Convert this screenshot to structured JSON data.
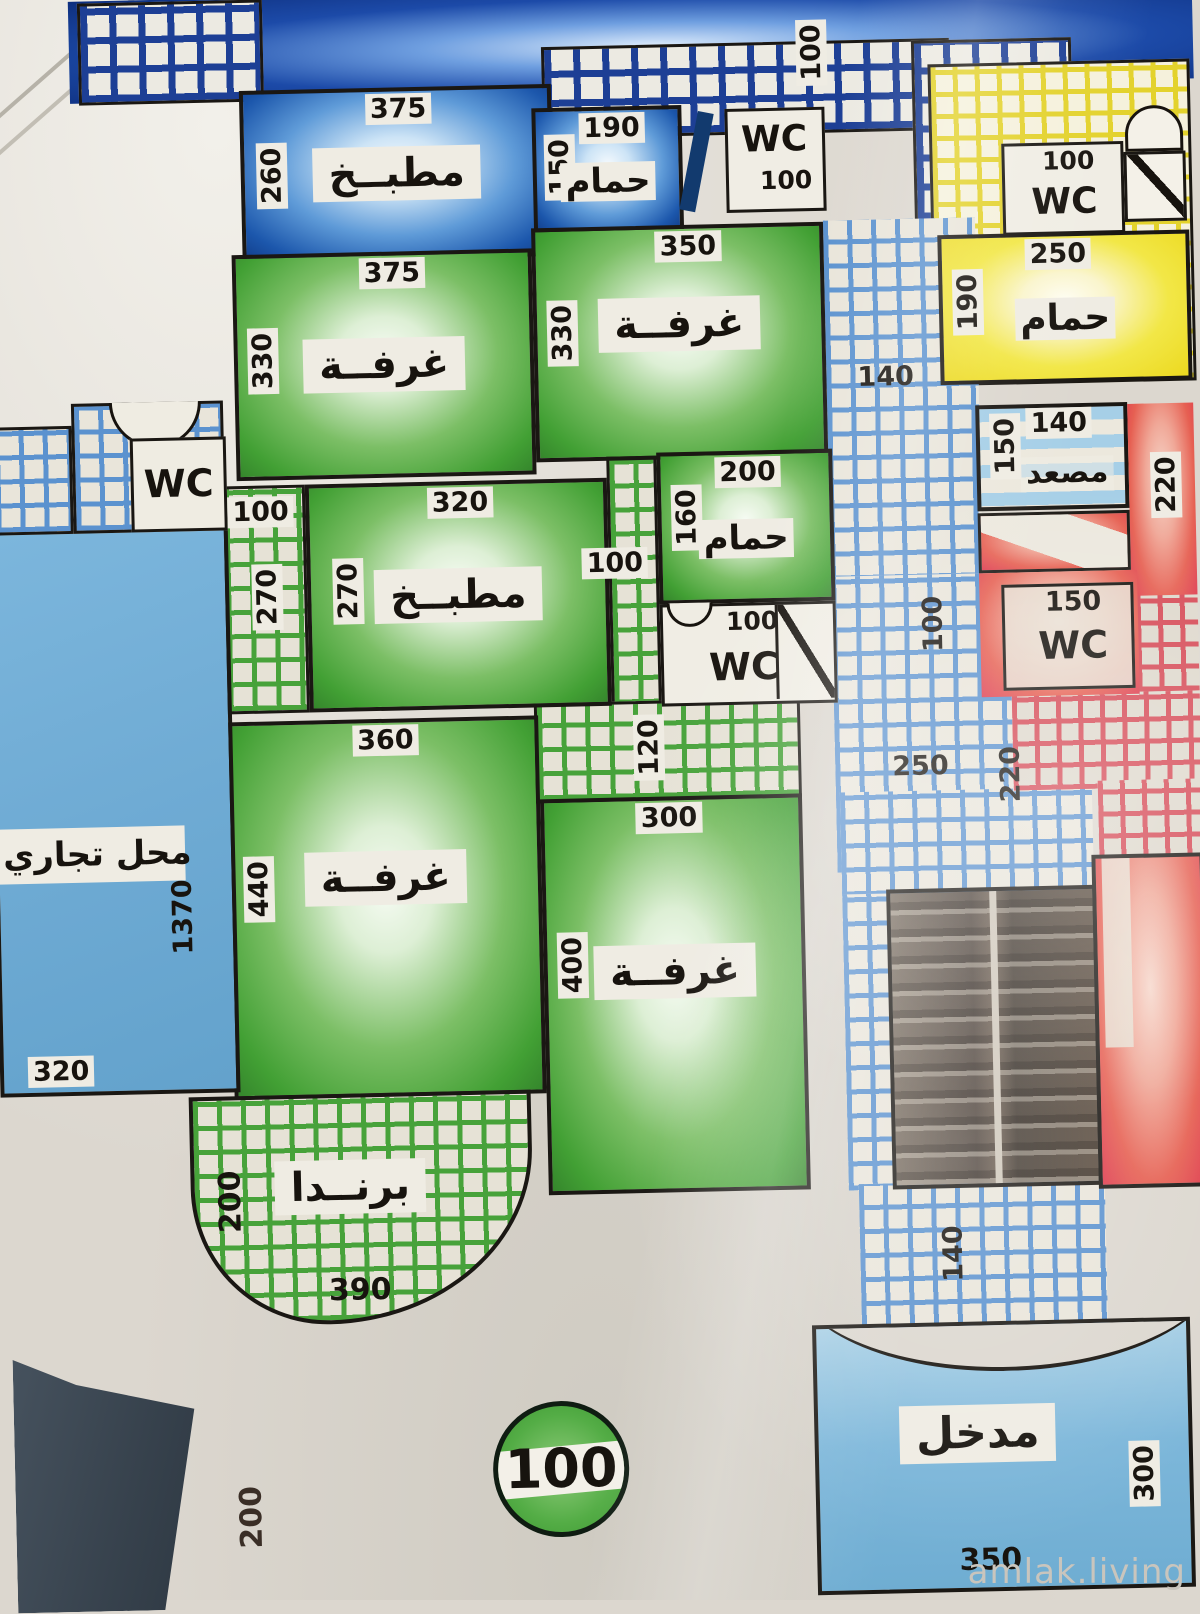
{
  "watermark": "amlak.living",
  "plan": {
    "blue_apt": {
      "kitchen": {
        "name": "مطبــخ",
        "top_dim": "375",
        "side_dim": "260"
      },
      "bathroom": {
        "name": "حمام",
        "top_dim": "190",
        "side_dim": "150"
      },
      "wc": {
        "label": "WC",
        "area_dim": "100"
      },
      "balcony_dim": "100"
    },
    "yellow_apt": {
      "wc": {
        "label": "WC",
        "area_dim": "100"
      },
      "bathroom": {
        "name": "حمام",
        "top_dim": "250",
        "side_dim": "190"
      }
    },
    "green_apt": {
      "room1": {
        "name": "غرفــة",
        "top_dim": "375",
        "side_dim": "330"
      },
      "room2": {
        "name": "غرفــة",
        "top_dim": "350",
        "side_dim": "330"
      },
      "hall_left": {
        "top_dim": "100",
        "side_dim": "270"
      },
      "kitchen": {
        "name": "مطبــخ",
        "top_dim": "320",
        "side_dim": "270"
      },
      "hall_mid_dim": "100",
      "bathroom": {
        "name": "حمام",
        "top_dim": "200",
        "side_dim": "160"
      },
      "wc": {
        "label": "WC",
        "area_dim": "100"
      },
      "hall_low_dim": "120",
      "room3": {
        "name": "غرفــة",
        "top_dim": "360",
        "side_dim": "440"
      },
      "room4": {
        "name": "غرفــة",
        "top_dim": "300",
        "side_dim": "400"
      },
      "veranda": {
        "name": "برنــدا",
        "side_dim": "200",
        "bottom_dim": "390"
      },
      "entry_circle_dim": "100"
    },
    "corridor": {
      "top_dim": "140",
      "mid_dim": "100",
      "low_dim": "250",
      "side_dim": "220",
      "stairs_dim": "140"
    },
    "elevator": {
      "name": "مصعد",
      "top_dim": "140",
      "side_dim": "150"
    },
    "red_apt": {
      "wc": {
        "label": "WC",
        "top_dim": "150"
      },
      "side_dim": "220"
    },
    "entrance": {
      "name": "مدخل",
      "bottom_dim": "350",
      "side_dim": "300"
    },
    "shop": {
      "name": "محل تجاري",
      "side_dim": "1370",
      "bottom_dim": "320"
    },
    "left_wc_label": "WC",
    "bottom_left_dim": "200"
  }
}
